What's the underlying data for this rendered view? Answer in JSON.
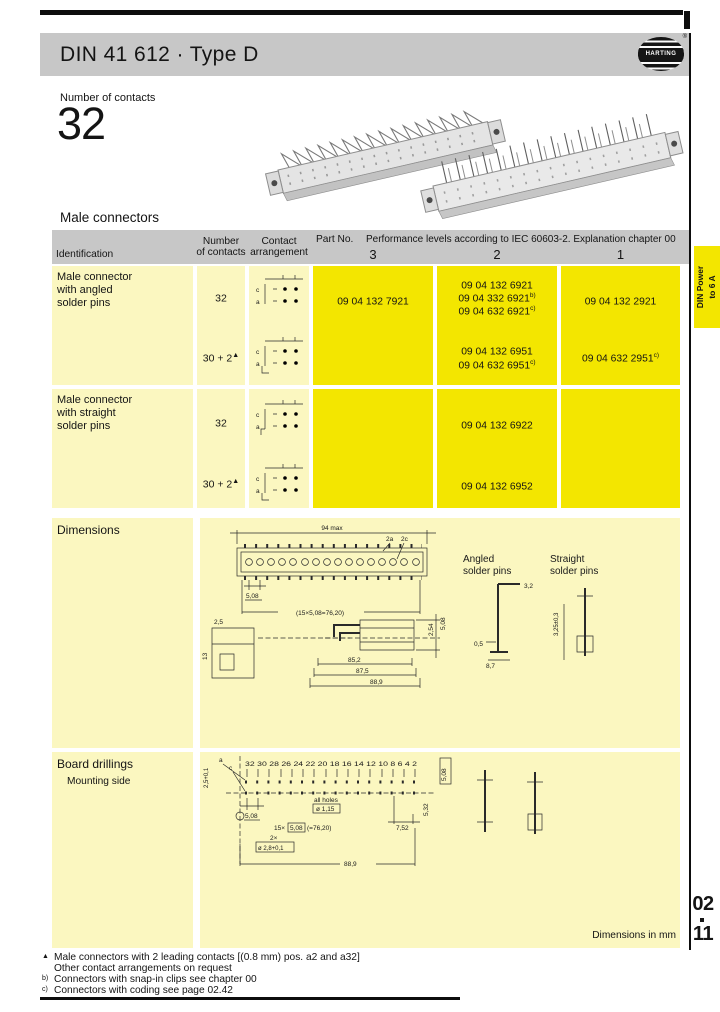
{
  "header": {
    "title": "DIN 41 612 · Type D",
    "brand": "HARTING",
    "reg": "®"
  },
  "intro": {
    "label": "Number of contacts",
    "value": "32"
  },
  "sections": {
    "male": "Male connectors",
    "dimensions": "Dimensions",
    "board": "Board drillings",
    "board_sub": "Mounting side",
    "dims_in_mm": "Dimensions in mm"
  },
  "side_tab": {
    "line1": "DIN Power",
    "line2": "to 6 A"
  },
  "page_no": {
    "chapter": "02",
    "page": "11"
  },
  "colors": {
    "accent_yellow": "#f3e600",
    "pale_yellow": "#fbf7c0",
    "band_gray": "#c7c7c7"
  },
  "table": {
    "head": {
      "identification": "Identification",
      "number1": "Number",
      "number2": "of contacts",
      "contact1": "Contact",
      "contact2": "arrangement",
      "part_no": "Part No.",
      "performance": "Performance levels according to IEC 60603-2. Explanation chapter 00",
      "levels": [
        "3",
        "2",
        "1"
      ]
    },
    "icon_rows": {
      "top": "c",
      "bottom": "a"
    },
    "groups": [
      {
        "id_lines": [
          "Male connector",
          "with angled",
          "solder pins"
        ],
        "rows": [
          {
            "contacts": "32",
            "sup": "",
            "p3": [
              {
                "t": "09 04 132 7921",
                "s": ""
              }
            ],
            "p2": [
              {
                "t": "09 04 132 6921",
                "s": ""
              },
              {
                "t": "09 04 332 6921",
                "s": "b)"
              },
              {
                "t": "09 04 632 6921",
                "s": "c)"
              }
            ],
            "p1": [
              {
                "t": "09 04 132 2921",
                "s": ""
              }
            ]
          },
          {
            "contacts": "30 + 2",
            "sup": "▲",
            "p2": [
              {
                "t": "09 04 132 6951",
                "s": ""
              },
              {
                "t": "09 04 632 6951",
                "s": "c)"
              }
            ],
            "p1": [
              {
                "t": "09 04 632 2951",
                "s": "c)"
              }
            ]
          }
        ]
      },
      {
        "id_lines": [
          "Male connector",
          "with straight",
          "solder pins"
        ],
        "rows": [
          {
            "contacts": "32",
            "sup": "",
            "p2": [
              {
                "t": "09 04 132 6922",
                "s": ""
              }
            ]
          },
          {
            "contacts": "30 + 2",
            "sup": "▲",
            "p2": [
              {
                "t": "09 04 132 6952",
                "s": ""
              }
            ]
          }
        ]
      }
    ]
  },
  "dim_drawing": {
    "overall": "94 max",
    "rows": "2a",
    "rows2": "2c",
    "pitch": "5,08",
    "pitch_total": "(15×5,08=76,20)",
    "d_25": "2,5",
    "d_13": "13",
    "v_254": "2,54",
    "v_508": "5,08",
    "len1": "85,2",
    "len2": "87,5",
    "len3": "88,9",
    "angled1": "Angled",
    "angled2": "solder pins",
    "straight1": "Straight",
    "straight2": "solder pins",
    "p_32": "3,2",
    "p_05": "0,5",
    "p_87": "8,7",
    "p_325": "3,25±0,3"
  },
  "board_drawing": {
    "numbers": "32 30 28 26 24 22 20 18 16 14 12 10 8 6 4 2",
    "row_a": "a",
    "row_c": "c",
    "edge": "2,5+0,1",
    "pitch": "5,08",
    "holes1": "all holes",
    "holes2": "ø 1,15",
    "pt1": "15×",
    "pt2": "5,08",
    "pt3": "(=76,20)",
    "fix1": "2×",
    "fix2": "ø 2,8+0,1",
    "d_752": "7,52",
    "d_532": "5,32",
    "d_508": "5,08",
    "total": "88,9"
  },
  "footnotes": [
    {
      "marker": "▲",
      "text": "Male connectors with 2 leading contacts [(0.8 mm) pos. a2 and a32]"
    },
    {
      "marker": "",
      "text": "Other contact arrangements on request"
    },
    {
      "marker": "b)",
      "text": "Connectors with snap-in clips see chapter 00"
    },
    {
      "marker": "c)",
      "text": "Connectors with coding see page 02.42"
    }
  ]
}
